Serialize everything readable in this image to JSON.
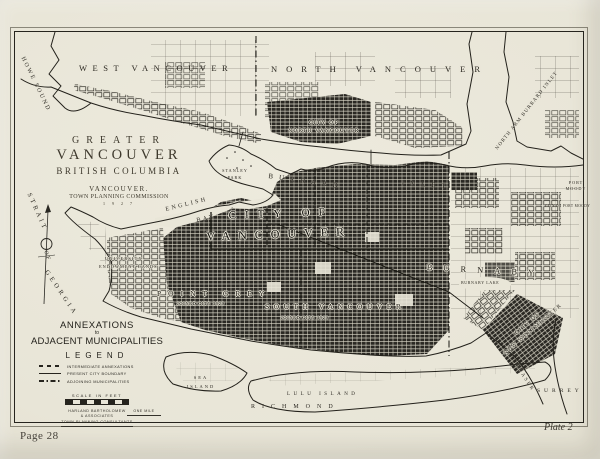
{
  "page": {
    "page_number": "Page 28",
    "plate_number": "Plate 2"
  },
  "title_block": {
    "region": "GREATER",
    "city": "VANCOUVER",
    "province": "BRITISH COLUMBIA",
    "commission_line1": "VANCOUVER.",
    "commission_line2": "TOWN PLANNING COMMISSION",
    "year": "1 9 2 7"
  },
  "annexations_block": {
    "heading_line1": "ANNEXATIONS",
    "heading_conjunction": "to",
    "heading_line2": "ADJACENT MUNICIPALITIES",
    "legend_title": "LEGEND",
    "items": [
      {
        "line_style": "dashed",
        "label": "INTERMEDIATE ANNEXATIONS"
      },
      {
        "line_style": "solid",
        "label": "PRESENT CITY BOUNDARY"
      },
      {
        "line_style": "dash-dot",
        "label": "ADJOINING MUNICIPALITIES"
      }
    ],
    "scale_label": "SCALE IN FEET",
    "one_mile_label": "ONE MILE",
    "credit_line1": "HARLAND BARTHOLOMEW",
    "credit_line2": "& ASSOCIATES",
    "credit_line3": "TOWN PLANNING CONSULTANTS"
  },
  "map_labels": {
    "howe_sound": "HOWE SOUND",
    "west_vancouver": "WEST VANCOUVER",
    "north_vancouver": "NORTH VANCOUVER",
    "city_of_north_vancouver_line1": "CITY OF",
    "city_of_north_vancouver_line2": "NORTH VANCOUVER",
    "north_arm_burrard_inlet": "NORTH ARM BURRARD INLET",
    "port_moody": "PORT MOODY",
    "city_of_port_moody": "CITY OF PORT MOODY",
    "stanley_park": "STANLEY PARK",
    "burrard": "BURRARD",
    "inlet": "INLET",
    "english": "ENGLISH",
    "bay": "BAY",
    "strait": "STRAIT",
    "of": "OF",
    "georgia": "GEORGIA",
    "university": "UNIVERSITY",
    "endowment_lands": "ENDOWMENT LANDS",
    "city_of_vancouver_line1": "CITY OF",
    "city_of_vancouver_line2": "VANCOUVER",
    "point_grey": "POINT GREY",
    "point_grey_note": "JOINED CITY 1929",
    "south_vancouver": "SOUTH VANCOUVER",
    "south_vancouver_note": "JOINED CITY 1929",
    "burnaby": "BURNABY",
    "burnaby_lake": "BURNABY LAKE",
    "new_westminster_line1": "CITY OF",
    "new_westminster_line2": "NEW WESTMINSTER",
    "fraser": "FRASER",
    "surrey": "SURREY",
    "sea": "SEA",
    "island": "ISLAND",
    "lulu_island": "LULU ISLAND",
    "richmond": "RICHMOND"
  },
  "colors": {
    "paper": "#e9e6d8",
    "ink": "#26241e"
  }
}
